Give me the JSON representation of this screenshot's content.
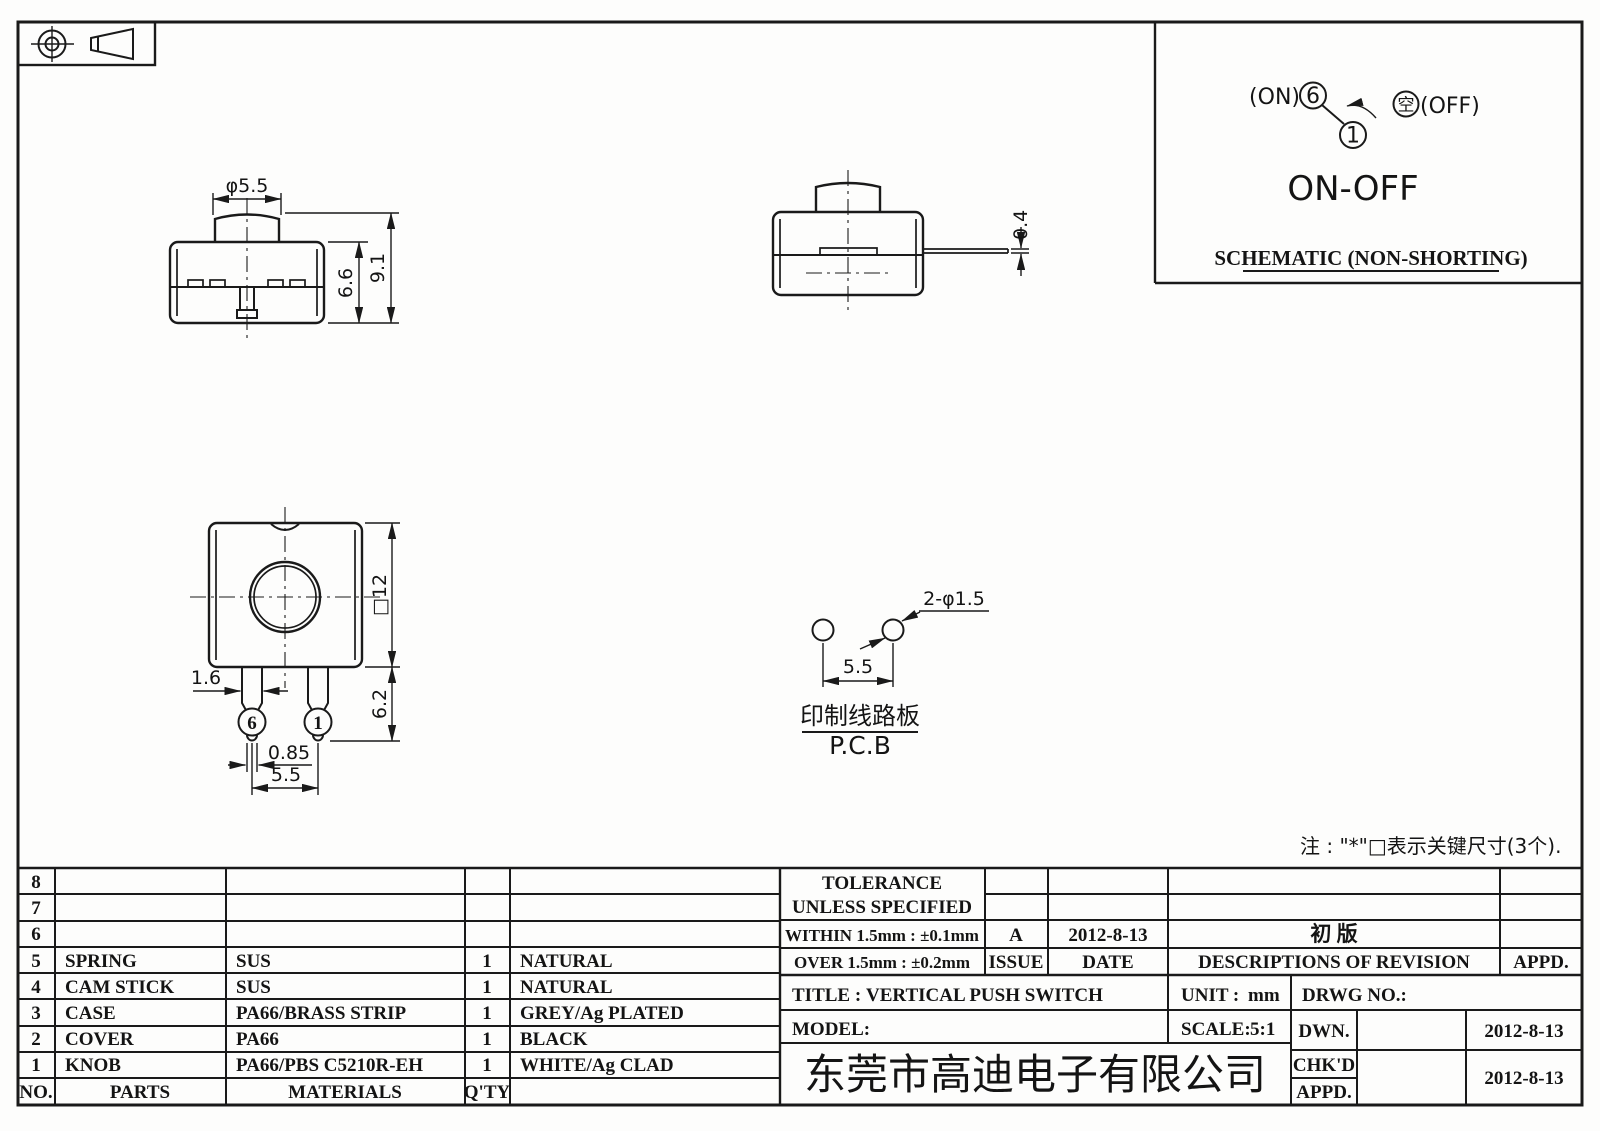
{
  "schematic": {
    "on_label": "(ON)",
    "terminal_on": "6",
    "terminal_common": "1",
    "off_symbol": "空",
    "off_label": "(OFF)",
    "function_label": "ON-OFF",
    "caption": "SCHEMATIC (NON-SHORTING)"
  },
  "views": {
    "front": {
      "dim_knob_dia": "φ5.5",
      "dim_body_height": "6.6",
      "dim_total_height": "9.1"
    },
    "side": {
      "dim_lead_thickness": "0.4"
    },
    "bottom": {
      "dim_body_square": "□12",
      "dim_pin_width": "1.6",
      "dim_pin_length": "6.2",
      "dim_tip_width": "0.85",
      "dim_pin_pitch": "5.5",
      "pin_left_no": "6",
      "pin_right_no": "1"
    },
    "pcb": {
      "dim_hole_pitch": "5.5",
      "dim_holes": "2-φ1.5",
      "label_cn": "印制线路板",
      "label_en": "P.C.B"
    }
  },
  "note": {
    "text": "注 : \"*\"□表示关键尺寸(3个)."
  },
  "parts_table": {
    "header": {
      "no": "NO.",
      "parts": "PARTS",
      "materials": "MATERIALS",
      "qty": "Q'TY",
      "finish": ""
    },
    "rows": [
      {
        "no": "8",
        "parts": "",
        "materials": "",
        "qty": "",
        "finish": ""
      },
      {
        "no": "7",
        "parts": "",
        "materials": "",
        "qty": "",
        "finish": ""
      },
      {
        "no": "6",
        "parts": "",
        "materials": "",
        "qty": "",
        "finish": ""
      },
      {
        "no": "5",
        "parts": "SPRING",
        "materials": "SUS",
        "qty": "1",
        "finish": "NATURAL"
      },
      {
        "no": "4",
        "parts": "CAM STICK",
        "materials": "SUS",
        "qty": "1",
        "finish": "NATURAL"
      },
      {
        "no": "3",
        "parts": "CASE",
        "materials": "PA66/BRASS STRIP",
        "qty": "1",
        "finish": "GREY/Ag PLATED"
      },
      {
        "no": "2",
        "parts": "COVER",
        "materials": "PA66",
        "qty": "1",
        "finish": "BLACK"
      },
      {
        "no": "1",
        "parts": "KNOB",
        "materials": "PA66/PBS C5210R-EH",
        "qty": "1",
        "finish": "WHITE/Ag CLAD"
      }
    ]
  },
  "tolerance": {
    "line1": "TOLERANCE",
    "line2": "UNLESS  SPECIFIED",
    "within": "WITHIN 1.5mm : ±0.1mm",
    "over": "OVER 1.5mm : ±0.2mm"
  },
  "revision": {
    "issue_value": "A",
    "date_value": "2012-8-13",
    "desc_value": "初  版",
    "issue_label": "ISSUE",
    "date_label": "DATE",
    "desc_label": "DESCRIPTIONS  OF  REVISION",
    "appd_label": "APPD."
  },
  "title_block": {
    "title_label": "TITLE :",
    "title_value": "VERTICAL  PUSH  SWITCH",
    "model_label": "MODEL:",
    "unit_label": "UNIT :",
    "unit_value": "mm",
    "scale_label": "SCALE:",
    "scale_value": "5:1",
    "drwg_label": "DRWG  NO.:",
    "dwn_label": "DWN.",
    "chkd_label": "CHK'D",
    "appd_label": "APPD.",
    "dwn_date": "2012-8-13",
    "chkd_date": "2012-8-13",
    "company": "东莞市高迪电子有限公司"
  }
}
